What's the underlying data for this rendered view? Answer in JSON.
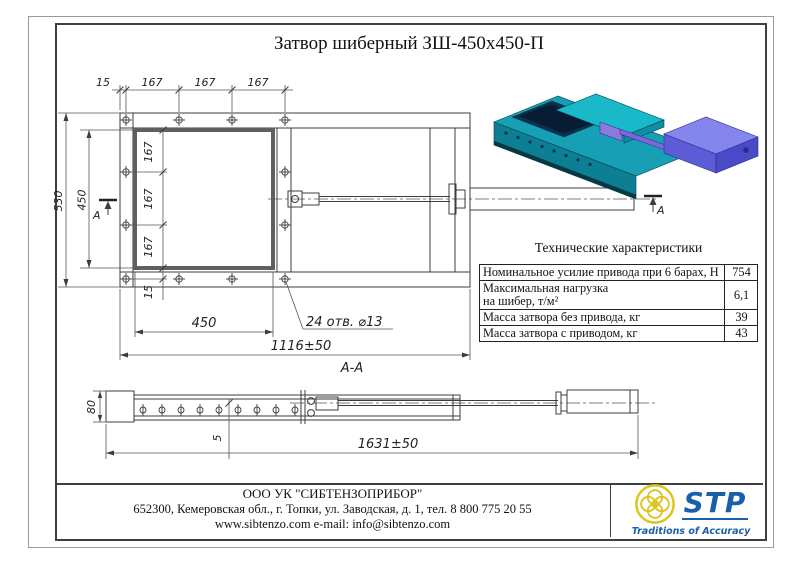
{
  "title": "Затвор шиберный ЗШ-450х450-П",
  "colors": {
    "line": "#3c3c3c",
    "body_teal": "#17a0b5",
    "body_teal_dark": "#0c7f94",
    "gate_teal": "#19b9c9",
    "opening_navy": "#0d2d52",
    "actuator_blue_top": "#8585ee",
    "actuator_blue_front": "#5c5cd6",
    "actuator_blue_end": "#4a4ac8",
    "rod_purple": "#7b68d8",
    "logo_blue": "#1a5fa8",
    "logo_yellow": "#dcc51e"
  },
  "front_view": {
    "section_label": "А",
    "dims": {
      "top_offset": "15",
      "top_pitch1": "167",
      "top_pitch2": "167",
      "top_pitch3": "167",
      "height_outer": "530",
      "height_opening": "450",
      "side_pitch1": "167",
      "side_pitch2": "167",
      "side_pitch3": "167",
      "bottom_offset": "15",
      "width_opening": "450",
      "length_body": "1116±50",
      "holes_note": "24 отв. ⌀13"
    }
  },
  "section_view": {
    "label": "А-А",
    "dims": {
      "height": "80",
      "plate": "5",
      "length_total": "1631±50"
    }
  },
  "spec_table": {
    "title": "Технические характеристики",
    "rows": [
      {
        "label": "Номинальное усилие привода при 6 барах, Н",
        "value": "754"
      },
      {
        "label": "Максимальная нагрузка",
        "label2": "на шибер, т/м²",
        "value": "6,1"
      },
      {
        "label": "Масса затвора без привода, кг",
        "value": "39"
      },
      {
        "label": "Масса затвора с приводом, кг",
        "value": "43"
      }
    ]
  },
  "footer": {
    "company": "ООО УК \"СИБТЕНЗОПРИБОР\"",
    "address": "652300, Кемеровская обл., г. Топки, ул. Заводская, д. 1, тел. 8 800 775 20 55",
    "web": "www.sibtenzo.com e-mail: info@sibtenzo.com",
    "logo_text": "STP",
    "logo_tagline": "Traditions of Accuracy"
  }
}
